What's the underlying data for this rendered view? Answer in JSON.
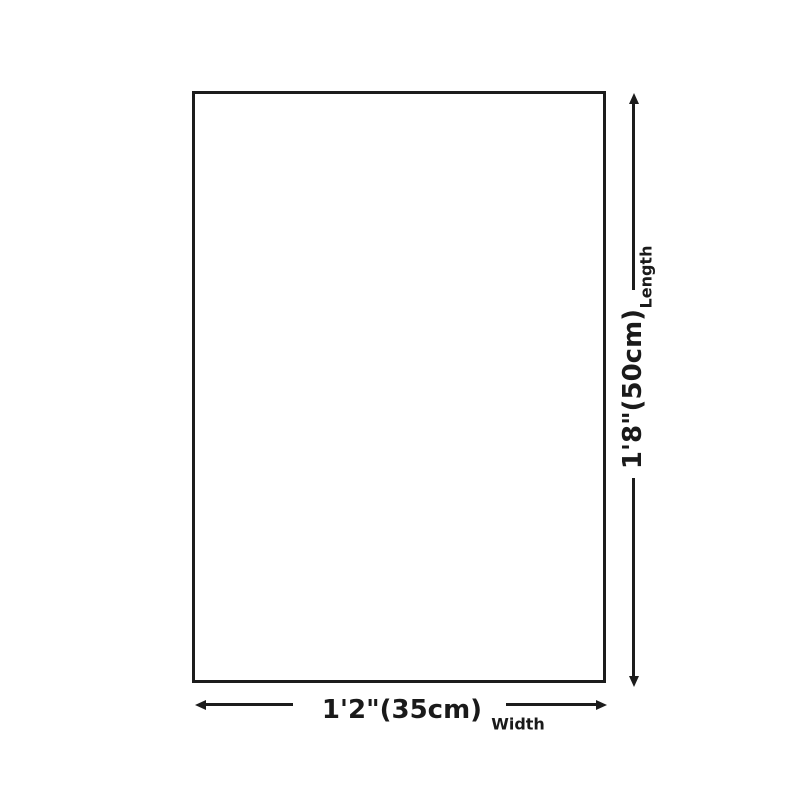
{
  "diagram": {
    "background_color": "#ffffff",
    "line_color": "#1c1c1c",
    "text_color": "#1a1a1a",
    "length_annotation": {
      "label": "Length",
      "value": "1'8\"(50cm)"
    },
    "width_annotation": {
      "label": "Width",
      "value": "1'2\"(35cm)"
    }
  }
}
